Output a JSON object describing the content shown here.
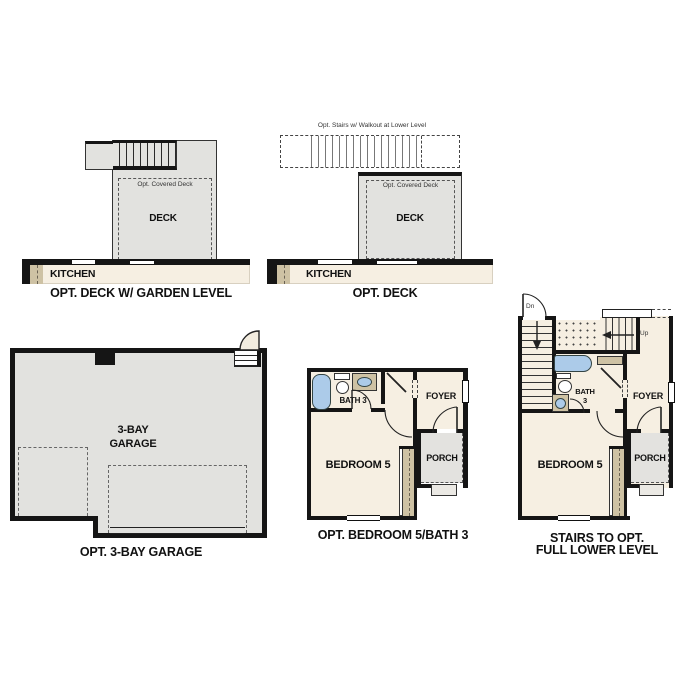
{
  "colors": {
    "wall": "#151515",
    "floor": "#f6efe2",
    "deck": "#e2e2df",
    "porch": "#e3e2df",
    "tan": "#cec2a4",
    "blue": "#accbe9",
    "step": "#ebe9e4",
    "dash": "#555555"
  },
  "figures": {
    "deck_garden": {
      "caption": "OPT. DECK W/ GARDEN LEVEL",
      "deck": "DECK",
      "covered": "Opt. Covered Deck",
      "kitchen": "KITCHEN"
    },
    "deck": {
      "caption": "OPT. DECK",
      "note": "Opt. Stairs w/ Walkout at Lower Level",
      "deck": "DECK",
      "covered": "Opt. Covered Deck",
      "kitchen": "KITCHEN"
    },
    "garage": {
      "caption": "OPT. 3-BAY GARAGE",
      "label1": "3-BAY",
      "label2": "GARAGE"
    },
    "bed5": {
      "caption": "OPT. BEDROOM 5/BATH 3",
      "bath": "BATH 3",
      "foyer": "FOYER",
      "bedroom": "BEDROOM 5",
      "porch": "PORCH"
    },
    "lower": {
      "caption1": "STAIRS TO OPT.",
      "caption2": "FULL LOWER LEVEL",
      "dn": "Dn",
      "up": "Up",
      "bath1": "BATH",
      "bath2": "3",
      "foyer": "FOYER",
      "bedroom": "BEDROOM 5",
      "porch": "PORCH"
    }
  }
}
